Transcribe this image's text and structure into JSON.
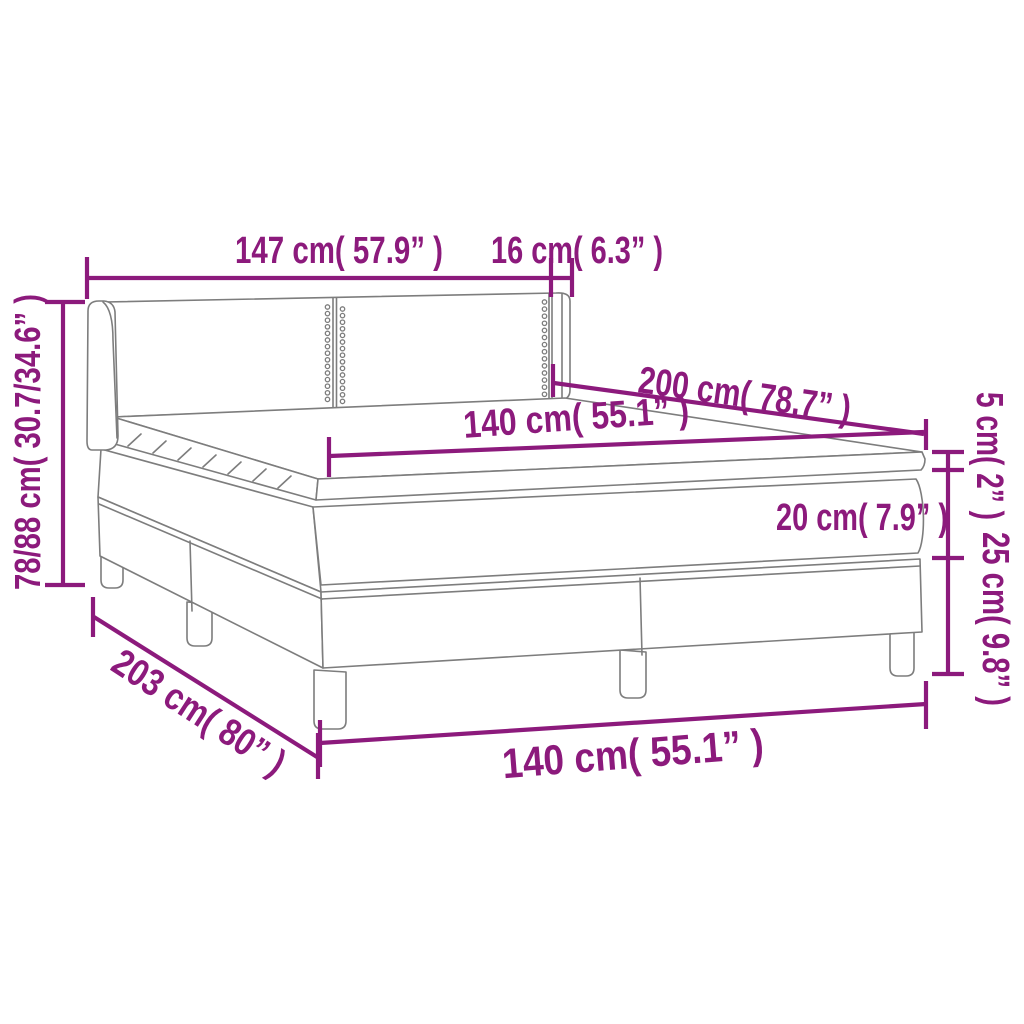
{
  "diagram": {
    "title": "Box spring bed with topper dimension diagram",
    "colors": {
      "dimension_color": "#8c1a7c",
      "line_art_color": "#7d7d7d",
      "background": "#ffffff"
    },
    "dimensions": {
      "headboard_width": "147 cm( 57.9” )",
      "wing_depth": "16 cm( 6.3” )",
      "bed_height": "78/88 cm( 30.7/34.6” )",
      "bed_length": "200 cm( 78.7” )",
      "mattress_width": "140 cm( 55.1” )",
      "topper_height": "5 cm( 2” )",
      "mattress_height": "20 cm( 7.9” )",
      "base_height": "25 cm( 9.8” )",
      "base_length": "203 cm( 80” )",
      "base_width": "140 cm( 55.1” )"
    }
  }
}
